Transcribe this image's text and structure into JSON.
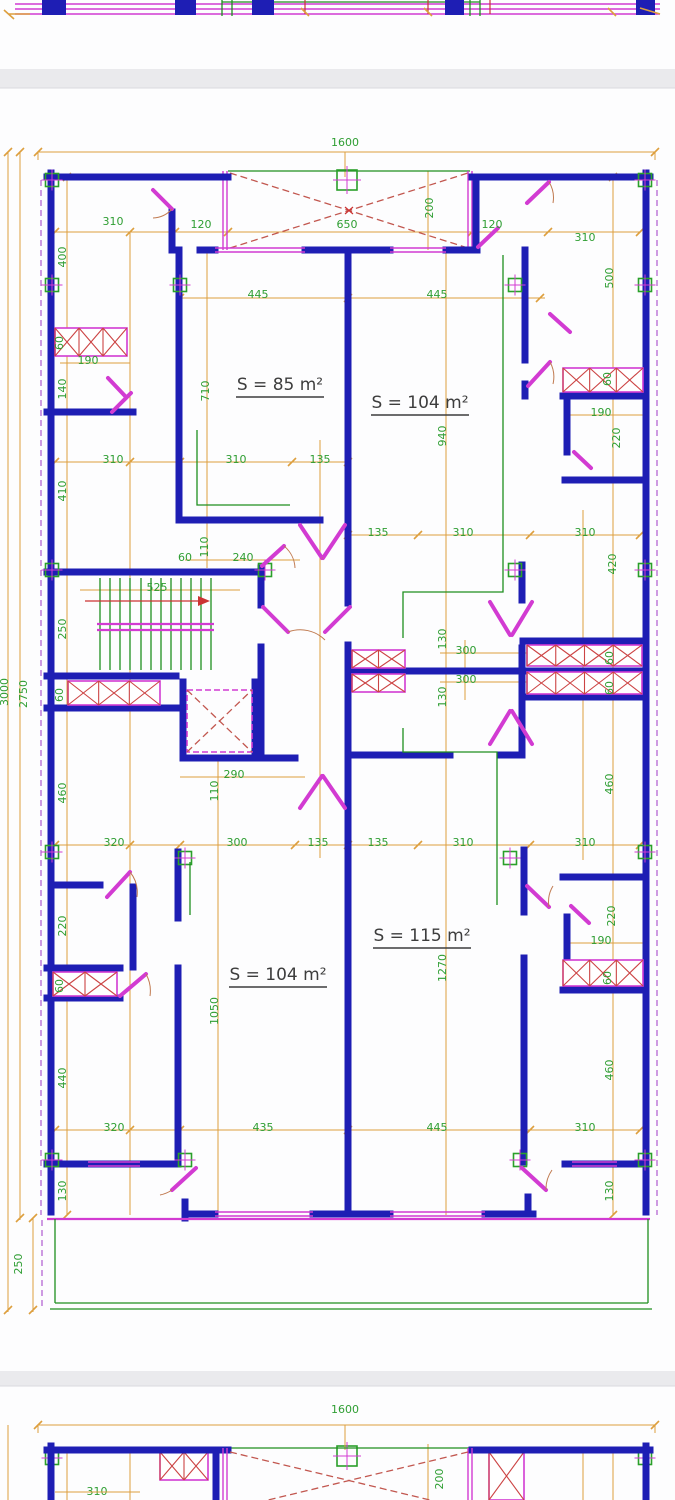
{
  "document": {
    "type": "architectural floor plan drawing",
    "sections": [
      "previous-plan-edge",
      "main-floor-plan",
      "next-plan-top"
    ]
  },
  "colors": {
    "wall": "#1e1eb4",
    "door_window": "#d23bd2",
    "dimension_line": "#dd9f3e",
    "dimension_text": "#2f9e33",
    "hatch": "#cc4444",
    "fixture_green": "#1f8f1f",
    "area_label": "#3d3d3d",
    "divider_bar": "#eaeaed"
  },
  "dims": [
    {
      "t": "1600",
      "x": 345,
      "y": 146,
      "r": 0,
      "s": 13
    },
    {
      "t": "310",
      "x": 113,
      "y": 225,
      "r": 0
    },
    {
      "t": "120",
      "x": 201,
      "y": 228,
      "r": 0
    },
    {
      "t": "650",
      "x": 347,
      "y": 228,
      "r": 0
    },
    {
      "t": "200",
      "x": 433,
      "y": 208,
      "r": -90
    },
    {
      "t": "120",
      "x": 492,
      "y": 228,
      "r": 0
    },
    {
      "t": "310",
      "x": 585,
      "y": 241,
      "r": 0
    },
    {
      "t": "400",
      "x": 66,
      "y": 257,
      "r": -90
    },
    {
      "t": "500",
      "x": 613,
      "y": 278,
      "r": -90
    },
    {
      "t": "445",
      "x": 258,
      "y": 298,
      "r": 0
    },
    {
      "t": "445",
      "x": 437,
      "y": 298,
      "r": 0
    },
    {
      "t": "60",
      "x": 63,
      "y": 343,
      "r": -90
    },
    {
      "t": "190",
      "x": 88,
      "y": 364,
      "r": 0
    },
    {
      "t": "140",
      "x": 66,
      "y": 389,
      "r": -90
    },
    {
      "t": "710",
      "x": 209,
      "y": 391,
      "r": -90
    },
    {
      "t": "60",
      "x": 611,
      "y": 379,
      "r": -90
    },
    {
      "t": "190",
      "x": 601,
      "y": 416,
      "r": 0
    },
    {
      "t": "220",
      "x": 620,
      "y": 438,
      "r": -90
    },
    {
      "t": "940",
      "x": 446,
      "y": 436,
      "r": -90
    },
    {
      "t": "310",
      "x": 113,
      "y": 463,
      "r": 0
    },
    {
      "t": "310",
      "x": 236,
      "y": 463,
      "r": 0
    },
    {
      "t": "135",
      "x": 320,
      "y": 463,
      "r": 0
    },
    {
      "t": "410",
      "x": 66,
      "y": 491,
      "r": -90
    },
    {
      "t": "135",
      "x": 378,
      "y": 536,
      "r": 0
    },
    {
      "t": "310",
      "x": 463,
      "y": 536,
      "r": 0
    },
    {
      "t": "310",
      "x": 585,
      "y": 536,
      "r": 0
    },
    {
      "t": "420",
      "x": 616,
      "y": 564,
      "r": -90
    },
    {
      "t": "110",
      "x": 208,
      "y": 547,
      "r": -90
    },
    {
      "t": "60",
      "x": 185,
      "y": 561,
      "r": 0
    },
    {
      "t": "240",
      "x": 243,
      "y": 561,
      "r": 0
    },
    {
      "t": "525",
      "x": 157,
      "y": 591,
      "r": 0
    },
    {
      "t": "250",
      "x": 66,
      "y": 629,
      "r": -90
    },
    {
      "t": "130",
      "x": 446,
      "y": 639,
      "r": -90
    },
    {
      "t": "300",
      "x": 466,
      "y": 654,
      "r": 0
    },
    {
      "t": "60",
      "x": 613,
      "y": 658,
      "r": -90
    },
    {
      "t": "300",
      "x": 466,
      "y": 683,
      "r": 0
    },
    {
      "t": "130",
      "x": 446,
      "y": 697,
      "r": -90
    },
    {
      "t": "60",
      "x": 613,
      "y": 688,
      "r": -90
    },
    {
      "t": "60",
      "x": 63,
      "y": 695,
      "r": -90
    },
    {
      "t": "290",
      "x": 234,
      "y": 778,
      "r": 0
    },
    {
      "t": "110",
      "x": 218,
      "y": 791,
      "r": -90
    },
    {
      "t": "460",
      "x": 66,
      "y": 793,
      "r": -90
    },
    {
      "t": "460",
      "x": 613,
      "y": 784,
      "r": -90
    },
    {
      "t": "320",
      "x": 114,
      "y": 846,
      "r": 0
    },
    {
      "t": "300",
      "x": 237,
      "y": 846,
      "r": 0
    },
    {
      "t": "135",
      "x": 318,
      "y": 846,
      "r": 0
    },
    {
      "t": "135",
      "x": 378,
      "y": 846,
      "r": 0
    },
    {
      "t": "310",
      "x": 463,
      "y": 846,
      "r": 0
    },
    {
      "t": "310",
      "x": 585,
      "y": 846,
      "r": 0
    },
    {
      "t": "220",
      "x": 66,
      "y": 926,
      "r": -90
    },
    {
      "t": "220",
      "x": 615,
      "y": 916,
      "r": -90
    },
    {
      "t": "190",
      "x": 601,
      "y": 944,
      "r": 0
    },
    {
      "t": "60",
      "x": 63,
      "y": 986,
      "r": -90
    },
    {
      "t": "60",
      "x": 611,
      "y": 978,
      "r": -90
    },
    {
      "t": "1270",
      "x": 446,
      "y": 968,
      "r": -90
    },
    {
      "t": "1050",
      "x": 218,
      "y": 1011,
      "r": -90
    },
    {
      "t": "440",
      "x": 66,
      "y": 1078,
      "r": -90
    },
    {
      "t": "460",
      "x": 613,
      "y": 1070,
      "r": -90
    },
    {
      "t": "320",
      "x": 114,
      "y": 1131,
      "r": 0
    },
    {
      "t": "435",
      "x": 263,
      "y": 1131,
      "r": 0
    },
    {
      "t": "445",
      "x": 437,
      "y": 1131,
      "r": 0
    },
    {
      "t": "310",
      "x": 585,
      "y": 1131,
      "r": 0
    },
    {
      "t": "130",
      "x": 66,
      "y": 1191,
      "r": -90
    },
    {
      "t": "130",
      "x": 613,
      "y": 1191,
      "r": -90
    },
    {
      "t": "250",
      "x": 22,
      "y": 1264,
      "r": -90
    },
    {
      "t": "2750",
      "x": 27,
      "y": 694,
      "r": -90,
      "s": 12
    },
    {
      "t": "3000",
      "x": 8,
      "y": 692,
      "r": -90,
      "s": 16
    },
    {
      "t": "1600",
      "x": 345,
      "y": 1413,
      "r": 0,
      "s": 13
    },
    {
      "t": "310",
      "x": 97,
      "y": 1495,
      "r": 0
    },
    {
      "t": "200",
      "x": 443,
      "y": 1479,
      "r": -90
    }
  ],
  "areas": [
    {
      "t": "S = 85 m²",
      "x": 280,
      "y": 390
    },
    {
      "t": "S = 104 m²",
      "x": 420,
      "y": 408
    },
    {
      "t": "S = 115 m²",
      "x": 422,
      "y": 941
    },
    {
      "t": "S = 104 m²",
      "x": 278,
      "y": 980
    }
  ]
}
